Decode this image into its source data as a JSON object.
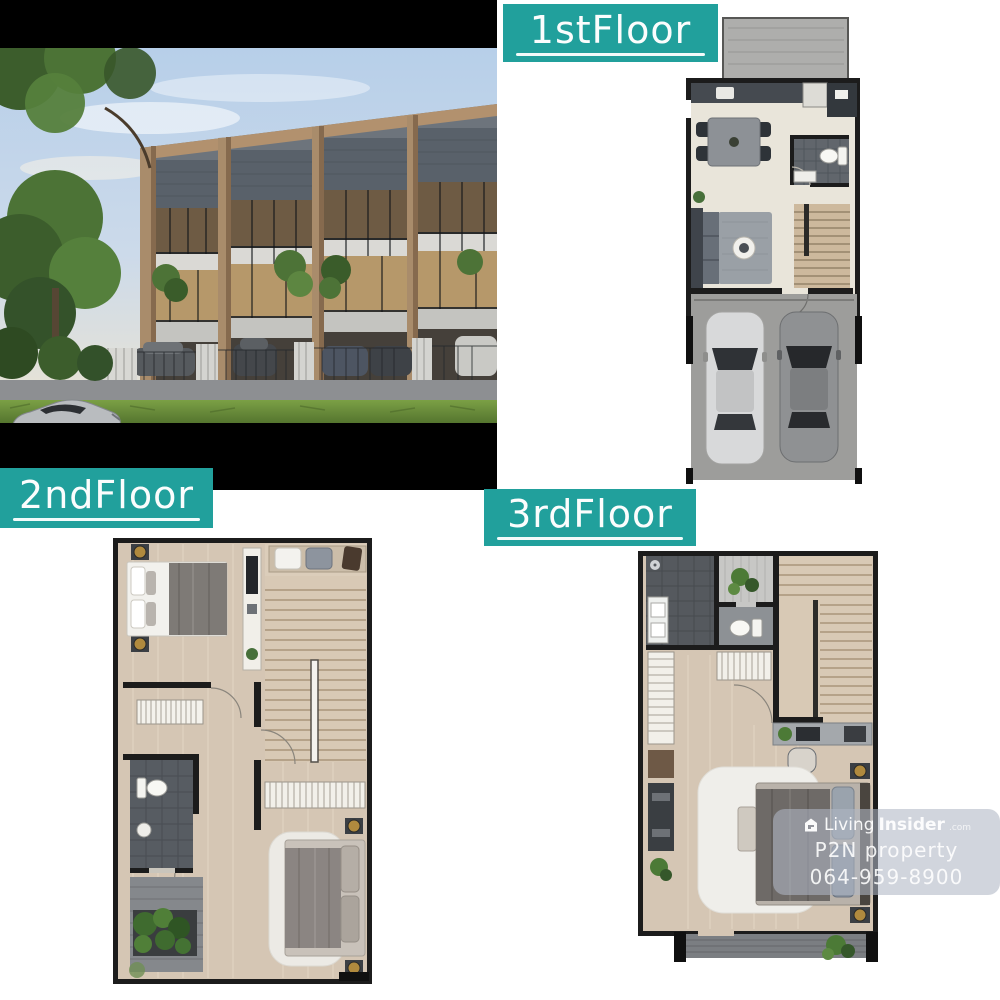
{
  "canvas": {
    "width": 1000,
    "height": 1000,
    "background": "#ffffff"
  },
  "colors": {
    "label_teal": "#21a09c",
    "label_text": "#ffffff",
    "photo_bar_black": "#000000",
    "plan_wall": "#1c1c1c",
    "plan_floor_cream": "#e9e5da",
    "plan_floor_wood": "#d5c6b4",
    "plan_tile_dark": "#565b60",
    "garage_gray": "#9d9d9b"
  },
  "floor_labels": [
    {
      "label": "1stFloor"
    },
    {
      "label": "2ndFloor"
    },
    {
      "label": "3rdFloor"
    }
  ],
  "watermark": {
    "icon": "house-logo-icon",
    "brand": {
      "part1": "Living",
      "part2": "Insider",
      "suffix": ".com"
    },
    "line2": "P2N property",
    "line3": "064-959-8900"
  }
}
